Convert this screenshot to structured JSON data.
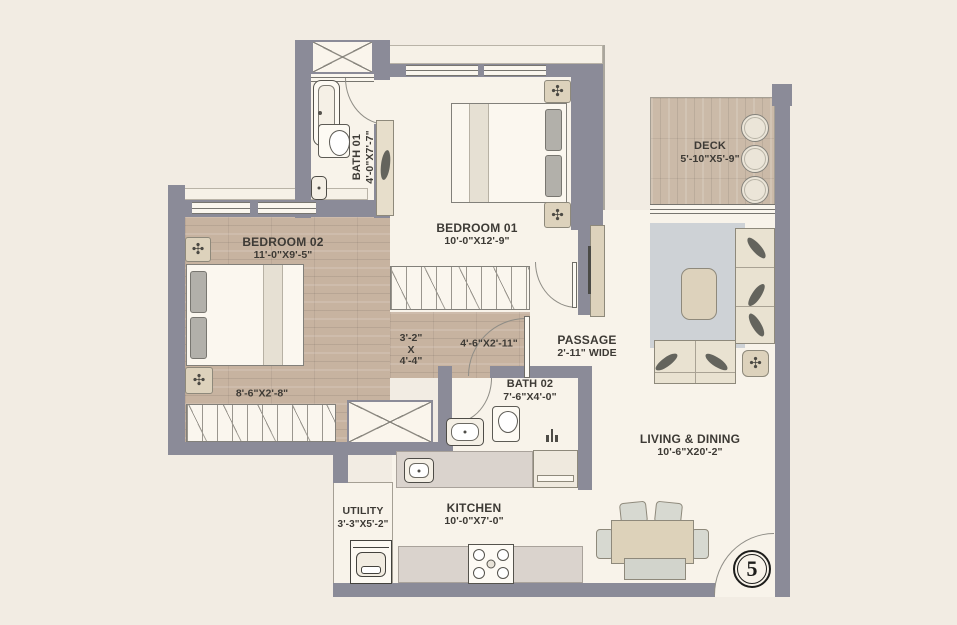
{
  "plan": {
    "unit_badge": "5",
    "rooms": {
      "bath01": {
        "name": "BATH 01",
        "dims": "4'-0\"X7'-7\""
      },
      "bedroom01": {
        "name": "BEDROOM 01",
        "dims": "10'-0\"X12'-9\""
      },
      "bedroom02": {
        "name": "BEDROOM 02",
        "dims": "11'-0\"X9'-5\""
      },
      "deck": {
        "name": "DECK",
        "dims": "5'-10\"X5'-9\""
      },
      "passage": {
        "name": "PASSAGE",
        "dims": "2'-11\" WIDE"
      },
      "bath02": {
        "name": "BATH 02",
        "dims": "7'-6\"X4'-0\""
      },
      "living": {
        "name": "LIVING & DINING",
        "dims": "10'-6\"X20'-2\""
      },
      "kitchen": {
        "name": "KITCHEN",
        "dims": "10'-0\"X7'-0\""
      },
      "utility": {
        "name": "UTILITY",
        "dims": "3'-3\"X5'-2\""
      }
    },
    "notes": {
      "passage_a": {
        "l1": "3'-2\"",
        "l2": "X",
        "l3": "4'-4\""
      },
      "passage_b": "4'-6\"X2'-11\"",
      "wardrobe_b2": "8'-6\"X2'-8\""
    },
    "icons": {
      "fan": "✣"
    },
    "colors": {
      "wall": "#8b8b98",
      "floor": "#f8f3ea",
      "wood": "#c7b3a0",
      "deck_wood": "#cbbaa8",
      "counter": "#dad3cd",
      "rug": "#ced2d6",
      "exterior": "#f2ece3",
      "text": "#3d3a35"
    }
  }
}
